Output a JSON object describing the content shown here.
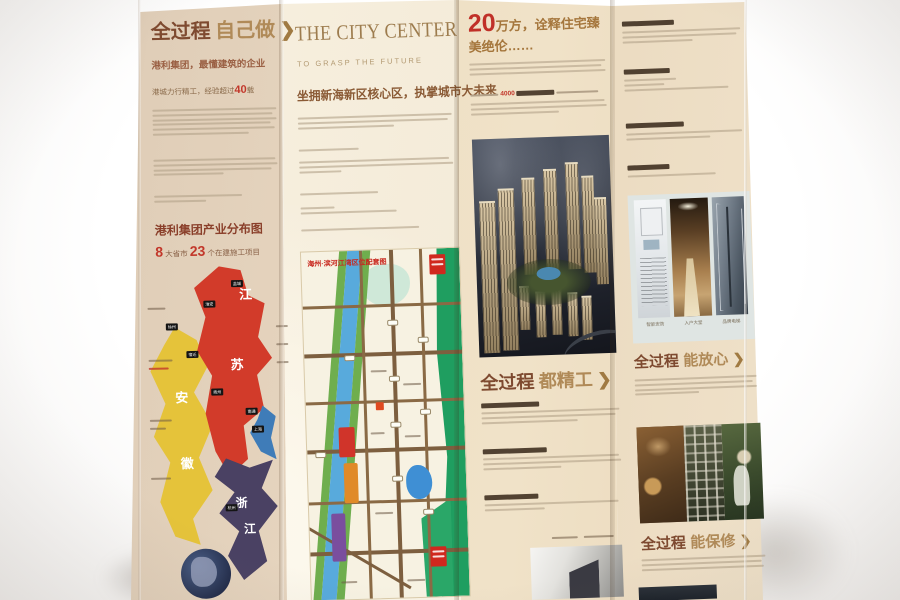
{
  "glyphs": {
    "chevron": "❯"
  },
  "colors": {
    "accent_red": "#c2372a",
    "heading_brown": "#7e4a30",
    "heading_tan": "#b08a58",
    "map_red": "#d23b2a",
    "map_yellow": "#e5c33a",
    "map_purple": "#4a4163",
    "map_blue": "#3f7cb8",
    "park_green": "#1f9e60",
    "river_blue": "#58aadc"
  },
  "panel1": {
    "title": {
      "main": "全过程",
      "accent": "自己做"
    },
    "subtitle": "港利集团，最懂建筑的企业",
    "experience": {
      "prefix": "港城力行精工，经验超过",
      "number": "40",
      "suffix": "载"
    },
    "map_section": {
      "title": "港利集团产业分布图",
      "stats": {
        "num1": "8",
        "label1": "大省市",
        "num2": "23",
        "label2": "个在建施工项目"
      },
      "regions": {
        "jiangsu": [
          "江",
          "苏"
        ],
        "anhui": [
          "安",
          "徽"
        ],
        "zhejiang": [
          "浙",
          "江"
        ]
      },
      "cities": [
        "盐城",
        "淮安",
        "徐州",
        "宿迁",
        "扬州",
        "南通",
        "上海",
        "杭州"
      ]
    }
  },
  "panel2": {
    "title": "THE CITY CENTER",
    "subtitle": "TO GRASP THE FUTURE",
    "headline": "坐拥新海新区核心区，执掌城市大未来",
    "map_title": "海州·滨河江湾区位配套图"
  },
  "panel3": {
    "headline": {
      "number": "20",
      "rest": "万方，诠释住宅臻美绝伦……"
    },
    "inline_number": "4000",
    "section": {
      "main": "全过程",
      "accent": "都精工"
    }
  },
  "panel4": {
    "sectionA": {
      "main": "全过程",
      "accent": "能放心"
    },
    "sectionB": {
      "main": "全过程",
      "accent": "能保修"
    },
    "photo_captions": [
      "智能安防",
      "入户大堂",
      "品牌电梯"
    ]
  }
}
